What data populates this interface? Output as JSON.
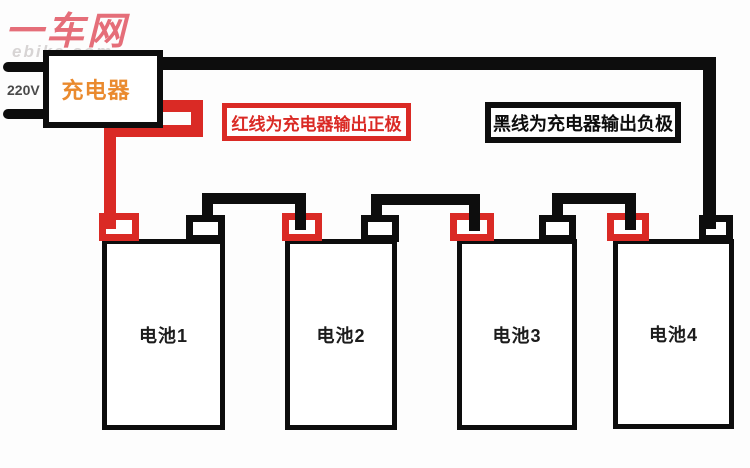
{
  "logo": {
    "text": "一车网",
    "watermark": "ebike.com"
  },
  "power": {
    "voltage_label": "220V"
  },
  "charger": {
    "label": "充电器"
  },
  "callouts": {
    "red_wire_note": "红线为充电器输出正极",
    "black_wire_note": "黑线为充电器输出负极"
  },
  "batteries": [
    {
      "label": "电池1"
    },
    {
      "label": "电池2"
    },
    {
      "label": "电池3"
    },
    {
      "label": "电池4"
    }
  ],
  "colors": {
    "wire_red": "#da2a25",
    "wire_black": "#0d0d0d",
    "charger_orange": "#ea8a2e",
    "logo_pink": "#e56e79",
    "watermark_gray": "#d7d4d4",
    "voltage_gray": "#4a4a4a",
    "battery_text": "#1c1c1c"
  }
}
